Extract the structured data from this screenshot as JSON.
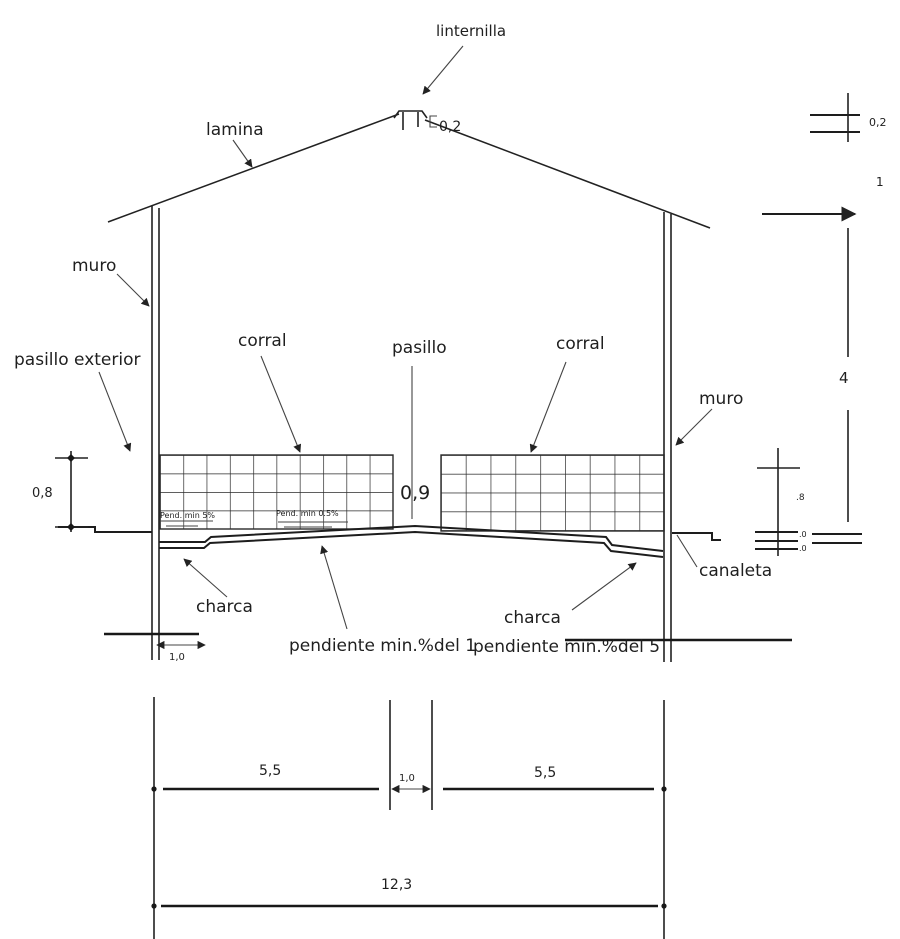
{
  "drawing": {
    "labels": {
      "linternilla": "linternilla",
      "lamina": "lamina",
      "muro_left": "muro",
      "muro_right": "muro",
      "pasillo_exterior": "pasillo exterior",
      "corral_left": "corral",
      "corral_right": "corral",
      "pasillo": "pasillo",
      "charca_left": "charca",
      "charca_right": "charca",
      "canaleta": "canaleta",
      "pend_min_5": "Pend. min 5%",
      "pend_min_05": "Pend. min 0.5%",
      "pendiente_min_1": "pendiente min.%del 1",
      "pendiente_min_5": "pendiente min.%del 5"
    },
    "dimensions": {
      "lantern_height": "0,2",
      "right_stack_02": "0,2",
      "right_stack_1": "1",
      "right_stack_4": "4",
      "right_stack_8": ".8",
      "right_stack_0_top": ".0",
      "right_stack_0_bottom": ".0",
      "fence_height_left": "0,8",
      "pasillo_depth": "0,9",
      "exterior_walk_width": "1,0",
      "span_corral_left": "5,5",
      "span_pasillo": "1,0",
      "span_corral_right": "5,5",
      "span_total": "12,3"
    },
    "colors": {
      "ink": "#1f1f1f",
      "background": "#ffffff"
    }
  }
}
